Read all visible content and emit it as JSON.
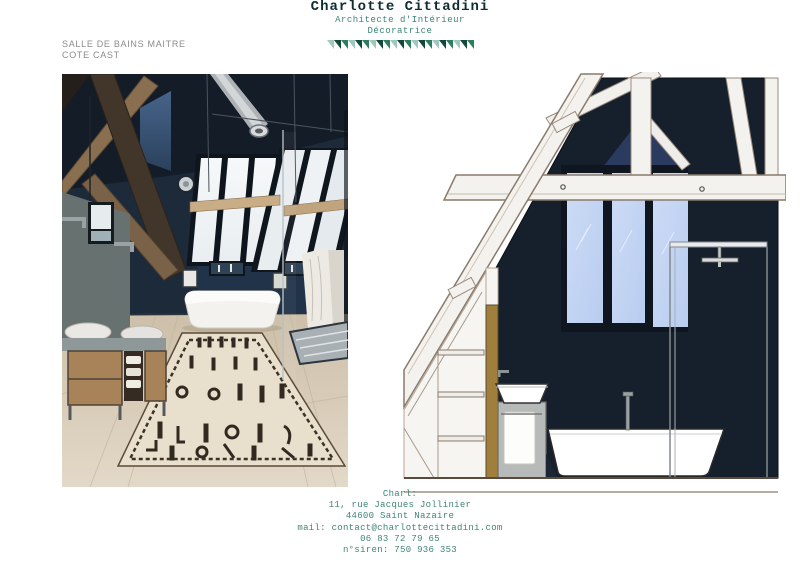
{
  "header": {
    "title": "Charlotte Cittadini",
    "subtitle_line1": "Architecte d'Intérieur",
    "subtitle_line2": "Décoratrice",
    "banner": {
      "triangle_count": 21,
      "triangle_colors": [
        "#9fc7bd",
        "#14483a",
        "#2f7d5f"
      ]
    }
  },
  "project_label": {
    "line1": "SALLE DE BAINS MAITRE",
    "line2": "COTE CAST"
  },
  "footer": {
    "lines": [
      "Charl:",
      "11, rue Jacques Jollinier",
      "44600 Saint Nazaire",
      "mail: contact@charlottecittadini.com",
      "06 83 72 79 65",
      "n°siren: 750 936 353"
    ]
  },
  "colors": {
    "accent_teal": "#3e8577",
    "title_dark": "#0e2e33",
    "label_gray": "#8c8c8c",
    "wall_navy": "#16202c",
    "window_blue": "#c5d6f4",
    "door_tan": "#a07f3d"
  }
}
